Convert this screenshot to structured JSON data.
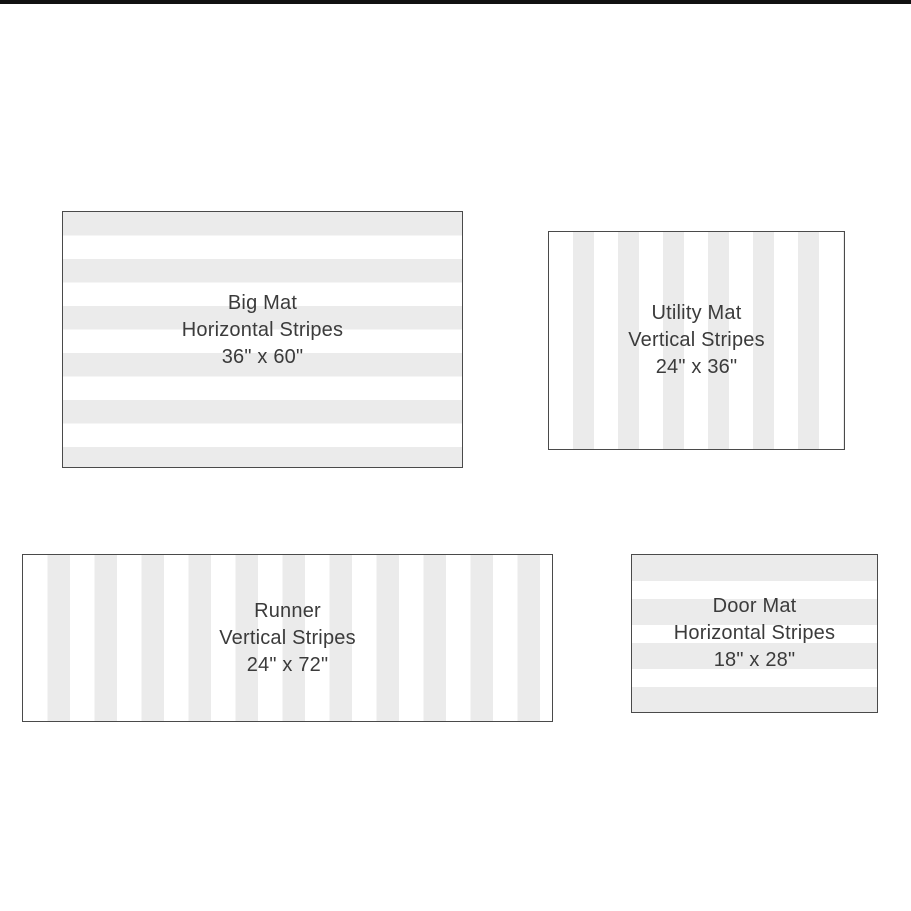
{
  "page": {
    "background_color": "#ffffff",
    "top_bar_color": "#111111",
    "stripe_color": "#ebebeb",
    "stripe_alt_color": "#ffffff",
    "swatch_border_color": "#4a4a4a",
    "text_color": "#3b3b3b"
  },
  "mats": {
    "big": {
      "name": "Big Mat",
      "pattern": "Horizontal Stripes",
      "size": "36\" x 60\""
    },
    "utility": {
      "name": "Utility Mat",
      "pattern": "Vertical Stripes",
      "size": "24\" x 36\""
    },
    "runner": {
      "name": "Runner",
      "pattern": "Vertical Stripes",
      "size": "24\" x 72\""
    },
    "door": {
      "name": "Door Mat",
      "pattern": "Horizontal Stripes",
      "size": "18\" x 28\""
    }
  }
}
